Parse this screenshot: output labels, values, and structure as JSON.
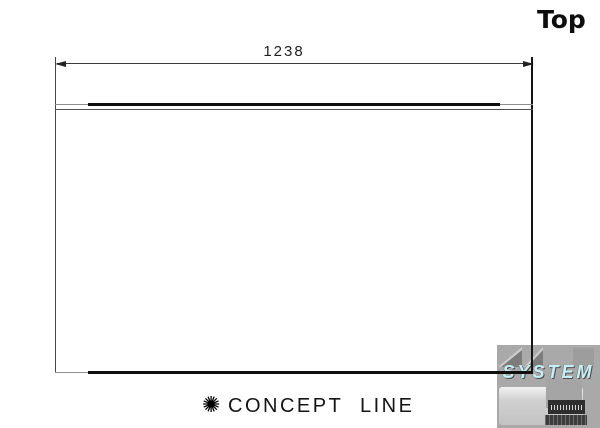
{
  "title": "Top",
  "dimension": {
    "value": "1238"
  },
  "footer": {
    "symbol": "✺",
    "brand": "CONCEPT LINE"
  },
  "watermark": {
    "text": "SYSTEM"
  },
  "colors": {
    "drawing_line": "#0f0f0f",
    "drawing_line_gray": "#8d8d8d",
    "watermark_bg": "#a9a9a9",
    "watermark_text": "#c6eef5"
  }
}
